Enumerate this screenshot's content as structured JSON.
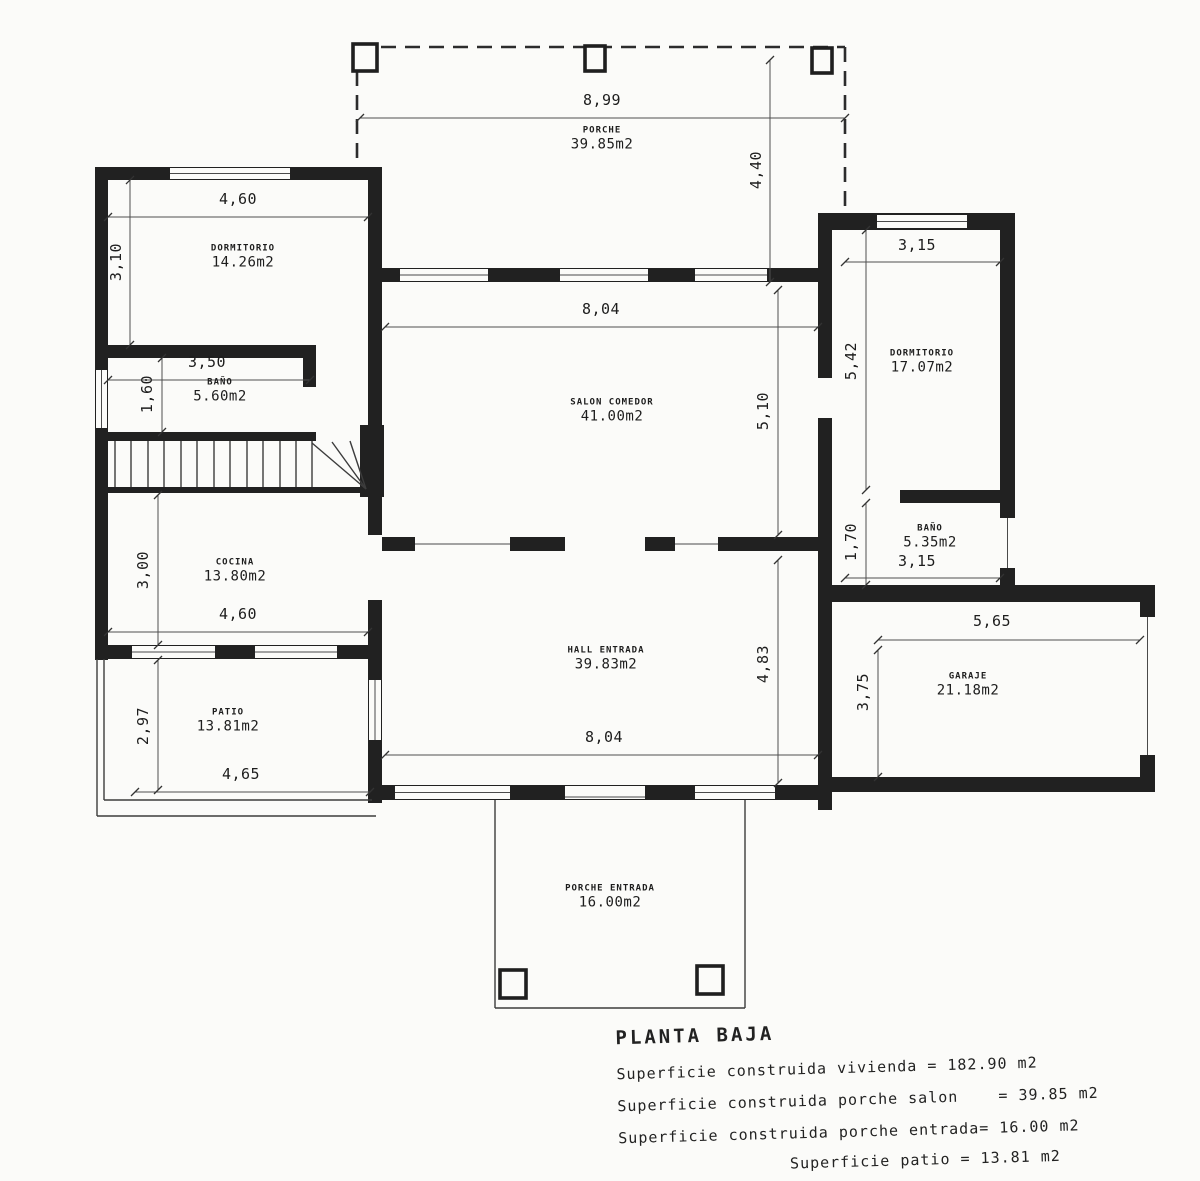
{
  "plan": {
    "type": "floor-plan",
    "language": "es",
    "colors": {
      "ink": "#1f1f1f",
      "paper": "#fbfbf9"
    }
  },
  "rooms": {
    "porche": {
      "name": "PORCHE",
      "area": "39.85m2"
    },
    "dormitorio1": {
      "name": "DORMITORIO",
      "area": "14.26m2"
    },
    "bano1": {
      "name": "BAÑO",
      "area": "5.60m2"
    },
    "salon": {
      "name": "SALON COMEDOR",
      "area": "41.00m2"
    },
    "cocina": {
      "name": "COCINA",
      "area": "13.80m2"
    },
    "patio": {
      "name": "PATIO",
      "area": "13.81m2"
    },
    "hall": {
      "name": "HALL ENTRADA",
      "area": "39.83m2"
    },
    "dormitorio2": {
      "name": "DORMITORIO",
      "area": "17.07m2"
    },
    "bano2": {
      "name": "BAÑO",
      "area": "5.35m2"
    },
    "garaje": {
      "name": "GARAJE",
      "area": "21.18m2"
    },
    "porche_entrada": {
      "name": "PORCHE ENTRADA",
      "area": "16.00m2"
    }
  },
  "dims": {
    "porche_width": "8,99",
    "porche_depth": "4,40",
    "dorm1_width": "4,60",
    "dorm1_depth": "3,10",
    "bano1_width": "3,50",
    "bano1_depth": "1,60",
    "cocina_depth": "3,00",
    "cocina_width": "4,60",
    "patio_depth": "2,97",
    "patio_width": "4,65",
    "salon_width": "8,04",
    "salon_depth": "5,10",
    "hall_width": "8,04",
    "hall_depth": "4,83",
    "dorm2_width": "3,15",
    "dorm2_depth": "5,42",
    "bano2_depth": "1,70",
    "bano2_width": "3,15",
    "garaje_width": "5,65",
    "garaje_depth": "3,75"
  },
  "summary": {
    "title": "PLANTA BAJA",
    "lines": [
      "Superficie construida vivienda = 182.90 m2",
      "Superficie construida porche salon    = 39.85 m2",
      "Superficie construida porche entrada= 16.00 m2",
      "Superficie patio = 13.81 m2"
    ]
  }
}
